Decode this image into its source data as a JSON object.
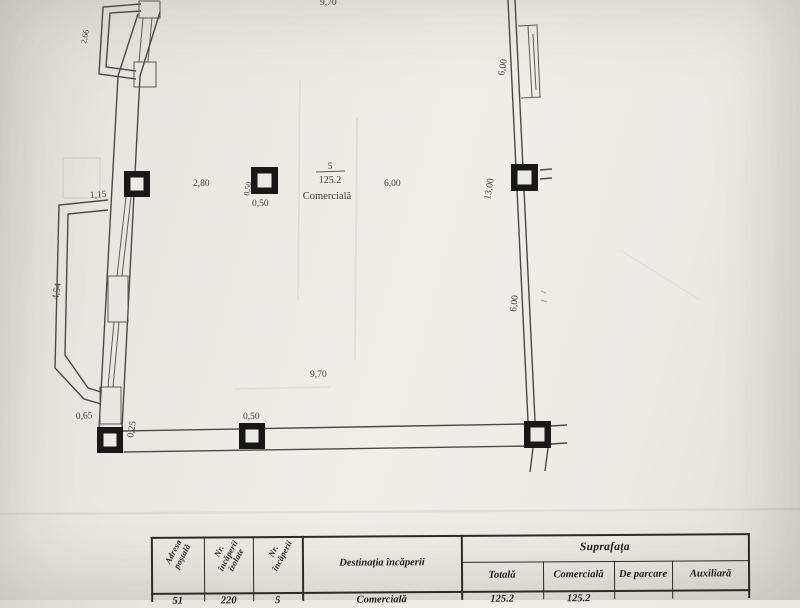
{
  "plan": {
    "room": {
      "number": "5",
      "area": "125.2",
      "type": "Comercială"
    },
    "dims": {
      "top_width": "9,70",
      "balcony_top": "2,66",
      "left_offset": "1,15",
      "balcony_left": "4,54",
      "balcony_bottom": "0,65",
      "bottom_corner": "0,25",
      "interior_left": "2,80",
      "interior_right": "6,00",
      "column_width": "0,50",
      "column_height": "0,50",
      "bottom_column": "0,50",
      "bottom_width": "9,70",
      "right_top": "6,00",
      "right_height": "13,00",
      "right_lower": "6,00"
    }
  },
  "table": {
    "headers": {
      "adresa_1": "Adresa",
      "adresa_2": "poștală",
      "izolate_1": "Nr.",
      "izolate_2": "încăperii",
      "izolate_3": "izolate",
      "nr_1": "Nr.",
      "nr_2": "încăperii",
      "destinatia": "Destinația încăperii",
      "suprafata": "Suprafața",
      "totala": "Totală",
      "comerciala": "Comercială",
      "de_parcare": "De parcare",
      "auxiliara": "Auxiliară"
    },
    "row": {
      "adresa": "51",
      "izolate": "220",
      "nr": "5",
      "destinatia": "Comercială",
      "totala": "125.2",
      "comerciala": "125.2",
      "de_parcare": "",
      "auxiliara": ""
    }
  }
}
